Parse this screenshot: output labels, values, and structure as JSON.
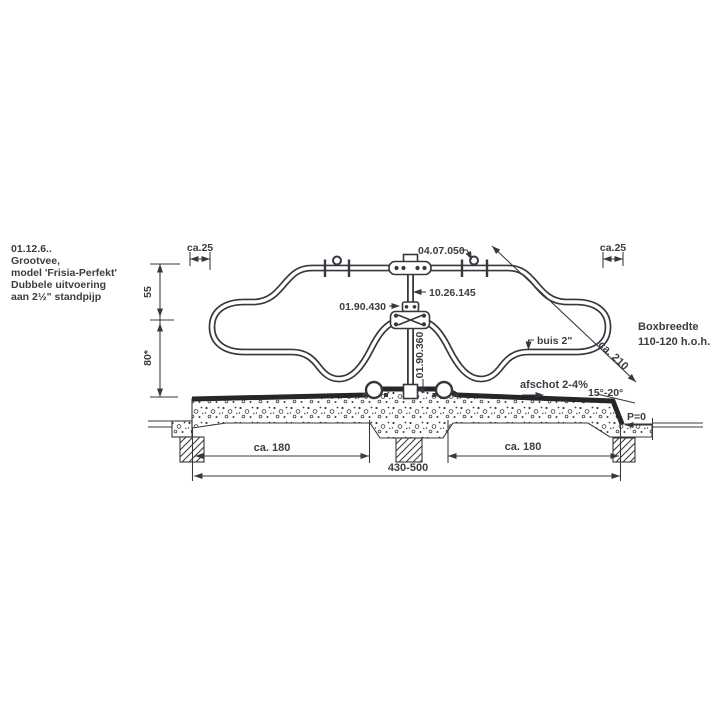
{
  "title_block": {
    "code": "01.12.6..",
    "name": "Grootvee,",
    "model": "model 'Frisia-Perfekt'",
    "variant": "Dubbele uitvoering",
    "mount": "aan 2½\" standpijp"
  },
  "dims": {
    "edge_left": "ca.25",
    "edge_right": "ca.25",
    "height_upper": "55",
    "height_lower": "80*",
    "width_left": "ca. 180",
    "width_right": "ca. 180",
    "width_total": "430-500",
    "diagonal": "ca. 210",
    "level": "P=0"
  },
  "labels": {
    "top_clamp": "04.07.050",
    "standpipe": "10.26.145",
    "collar": "01.90.430",
    "ground_socket": "01.90.360",
    "tube": "buis 2\"",
    "slope": "afschot 2-4%",
    "bevel_angle": "15°-20°",
    "box_width_1": "Boxbreedte",
    "box_width_2": "110-120 h.o.h."
  },
  "colors": {
    "line": "#35383d",
    "text": "#3a3d42",
    "background": "#ffffff"
  }
}
